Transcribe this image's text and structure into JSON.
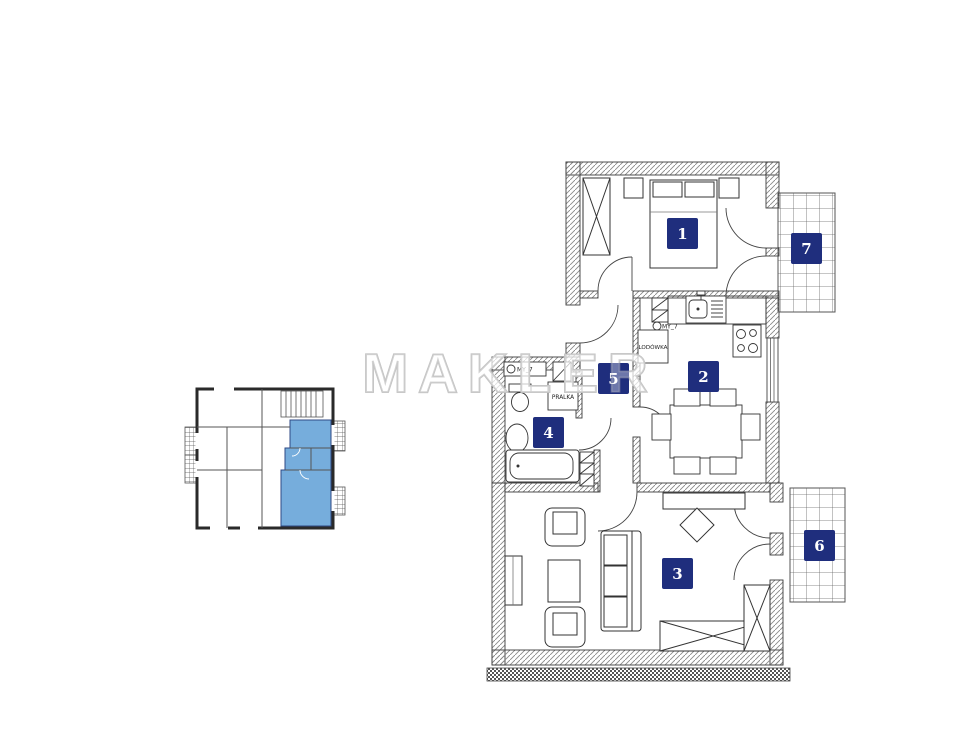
{
  "watermark": {
    "text": "MAKLER"
  },
  "colors": {
    "label_bg": "#1f2e7d",
    "label_text": "#ffffff",
    "highlight": "#6fa9db",
    "wall_stroke": "#3c3c3c",
    "hatch_line": "#8a8a8a",
    "balcony_grid": "#666666",
    "watermark_gray": "#c2c2c2"
  },
  "rooms": [
    {
      "number": "1"
    },
    {
      "number": "2"
    },
    {
      "number": "3"
    },
    {
      "number": "4"
    },
    {
      "number": "5"
    },
    {
      "number": "6"
    },
    {
      "number": "7"
    }
  ],
  "fixtures": {
    "fridge": "LODÓWKA",
    "washer": "PRALKA",
    "vent": "MY_7"
  }
}
